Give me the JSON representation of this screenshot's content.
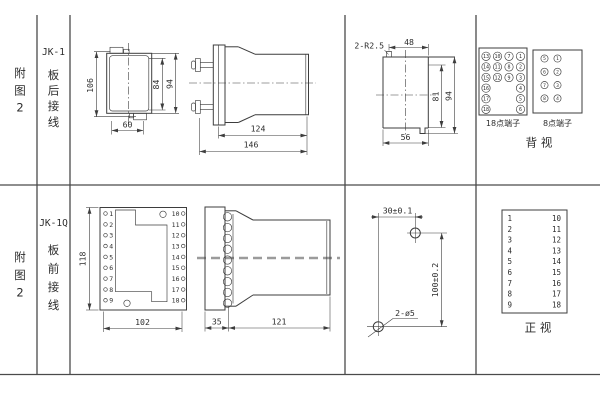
{
  "sidebar_top": {
    "figure": [
      "附",
      "图",
      "2"
    ],
    "model": "JK-1",
    "wiring": [
      "板",
      "后",
      "接",
      "线"
    ]
  },
  "sidebar_bottom": {
    "figure": [
      "附",
      "图",
      "2"
    ],
    "model": "JK-1Q",
    "wiring": [
      "板",
      "前",
      "接",
      "线"
    ]
  },
  "top_row": {
    "case_front": {
      "dim_height": "106",
      "dim_inner_height": "84",
      "dim_outer_height": "94",
      "dim_width": "60"
    },
    "case_side": {
      "dim_body_length": "124",
      "dim_total_length": "146"
    },
    "panel_cutout": {
      "corner_radius": "2-R2.5",
      "dim_top_width": "48",
      "dim_inner_height": "81",
      "dim_outer_height": "94",
      "dim_bottom_width": "56"
    },
    "terminal_18": {
      "label": "18点端子",
      "col1": [
        "13",
        "14",
        "15",
        "16",
        "17",
        "18"
      ],
      "col2": [
        "10",
        "11",
        "12"
      ],
      "col3": [
        "7",
        "8",
        "9"
      ],
      "col4": [
        "1",
        "2",
        "3",
        "4",
        "5",
        "6"
      ]
    },
    "terminal_8": {
      "label": "8点端子",
      "left_col": [
        "5",
        "6",
        "7",
        "8"
      ],
      "right_col": [
        "1",
        "2",
        "3",
        "4"
      ]
    },
    "view_label": "背  视"
  },
  "bottom_row": {
    "panel_front": {
      "dim_height": "118",
      "dim_width": "102",
      "left_terminals": [
        "1",
        "2",
        "3",
        "4",
        "5",
        "6",
        "7",
        "8",
        "9"
      ],
      "right_terminals": [
        "10",
        "11",
        "12",
        "13",
        "14",
        "15",
        "16",
        "17",
        "18"
      ]
    },
    "panel_side": {
      "dim_depth": "35",
      "dim_body_length": "121"
    },
    "drill_template": {
      "dim_horizontal": "30±0.1",
      "dim_vertical": "100±0.2",
      "holes_label": "2-ø5"
    },
    "terminal_table": {
      "left_col": [
        "1",
        "2",
        "3",
        "4",
        "5",
        "6",
        "7",
        "8",
        "9"
      ],
      "right_col": [
        "10",
        "11",
        "12",
        "13",
        "14",
        "15",
        "16",
        "17",
        "18"
      ],
      "view_label": "正  视"
    }
  },
  "colors": {
    "line": "#3d3d3d",
    "frame": "#4a4a4a",
    "text": "#2c2c2c",
    "centerline_gray": "#9b9b9b",
    "background": "#ffffff"
  }
}
